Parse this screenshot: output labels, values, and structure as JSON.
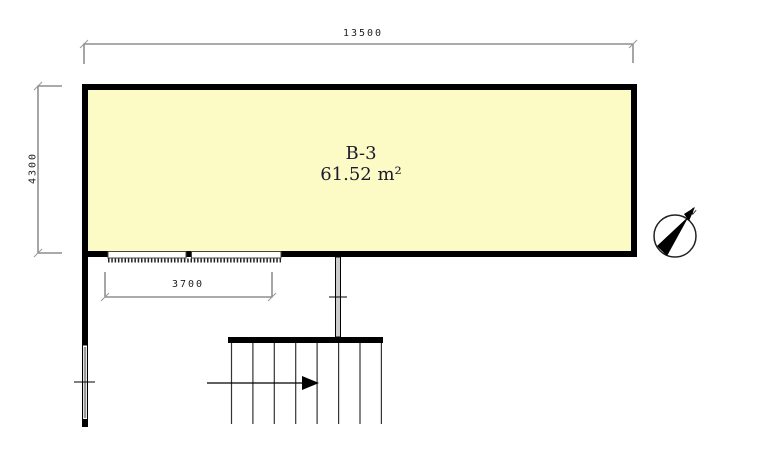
{
  "floorplan": {
    "room": {
      "name": "B-3",
      "area": "61.52 m²"
    },
    "dimensions": {
      "top_width": "13500",
      "left_height": "4300",
      "bottom_window_width": "3700"
    },
    "compass": {
      "north_label": "N"
    },
    "colors": {
      "room_fill": "#FCFAC5",
      "wall": "#000000",
      "dimension_line": "#777777",
      "dimension_text": "#222222",
      "room_text": "#1b1b2f"
    }
  }
}
